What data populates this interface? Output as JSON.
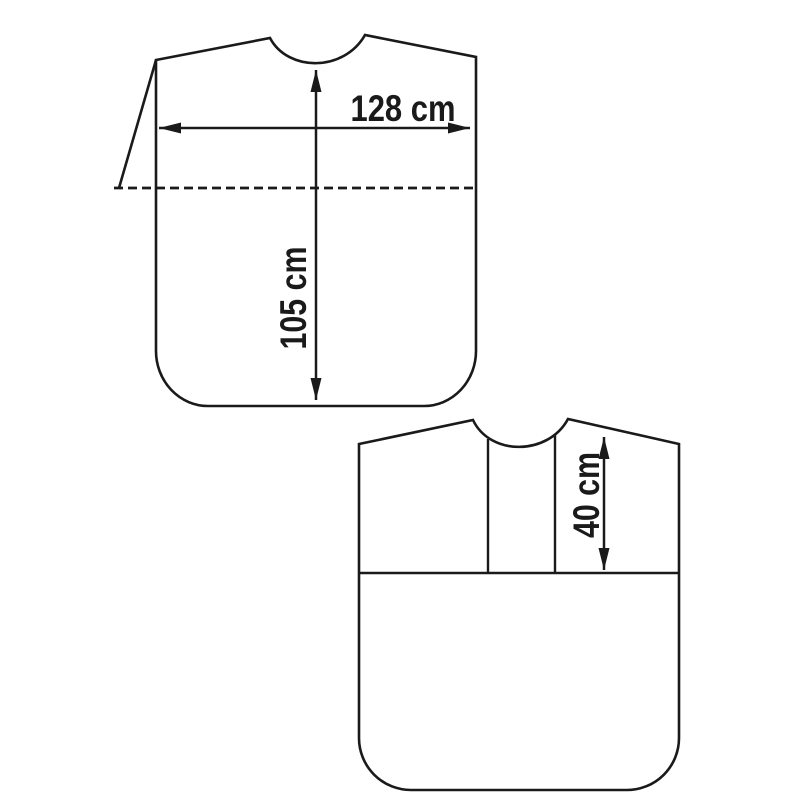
{
  "page": {
    "background_color": "#ffffff",
    "line_color": "#1a1a1a"
  },
  "diagram": {
    "type": "garment-measurement-drawing",
    "pieces": [
      {
        "id": "upper-garment-piece",
        "features": [
          "neckline-curve",
          "side-flap",
          "dashed-fold-line",
          "rounded-bottom-corners"
        ],
        "measurements": [
          {
            "label": "128 cm",
            "value": 128,
            "unit": "cm",
            "orientation": "horizontal"
          },
          {
            "label": "105 cm",
            "value": 105,
            "unit": "cm",
            "orientation": "vertical"
          }
        ]
      },
      {
        "id": "lower-garment-piece",
        "features": [
          "neckline-curve",
          "neck-panel-lines",
          "yoke-seam-line",
          "rounded-bottom-corners"
        ],
        "measurements": [
          {
            "label": "40 cm",
            "value": 40,
            "unit": "cm",
            "orientation": "vertical"
          }
        ]
      }
    ]
  }
}
